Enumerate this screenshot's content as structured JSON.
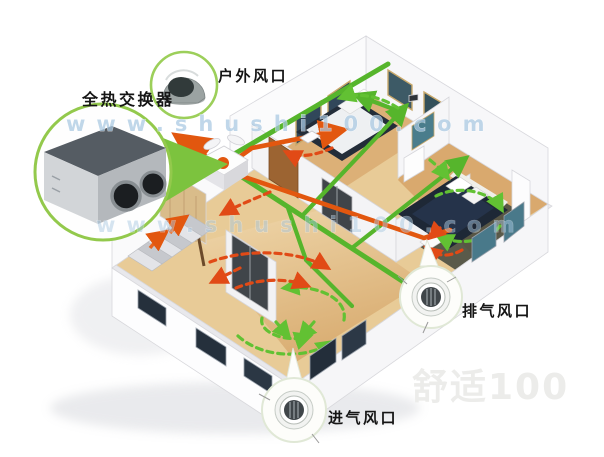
{
  "callouts": {
    "heat_exchanger": {
      "label": "全热交换器",
      "icon": "heat-recovery-unit"
    },
    "outdoor_vent": {
      "label": "户外风口",
      "icon": "outdoor-hood-vent"
    },
    "exhaust_vent": {
      "label": "排气风口",
      "icon": "round-ceiling-grille"
    },
    "intake_vent": {
      "label": "进气风口",
      "icon": "round-ceiling-grille"
    }
  },
  "watermarks": {
    "url": "www.shushi100.com",
    "brand": "舒适100"
  },
  "colors": {
    "supply_duct_green": "#56b52c",
    "exhaust_duct_orange": "#e2570f",
    "supply_arrow_green": "#62c133",
    "exhaust_arrow_red": "#e14a16",
    "callout_ring_green": "#93c94c",
    "wood_floor": "#e8cb97",
    "window_dark": "#25303c",
    "window_teal": "#49798a",
    "watermark_blue": "#a9c9e2",
    "watermark_gray": "#ececea",
    "label_black": "#151515"
  }
}
